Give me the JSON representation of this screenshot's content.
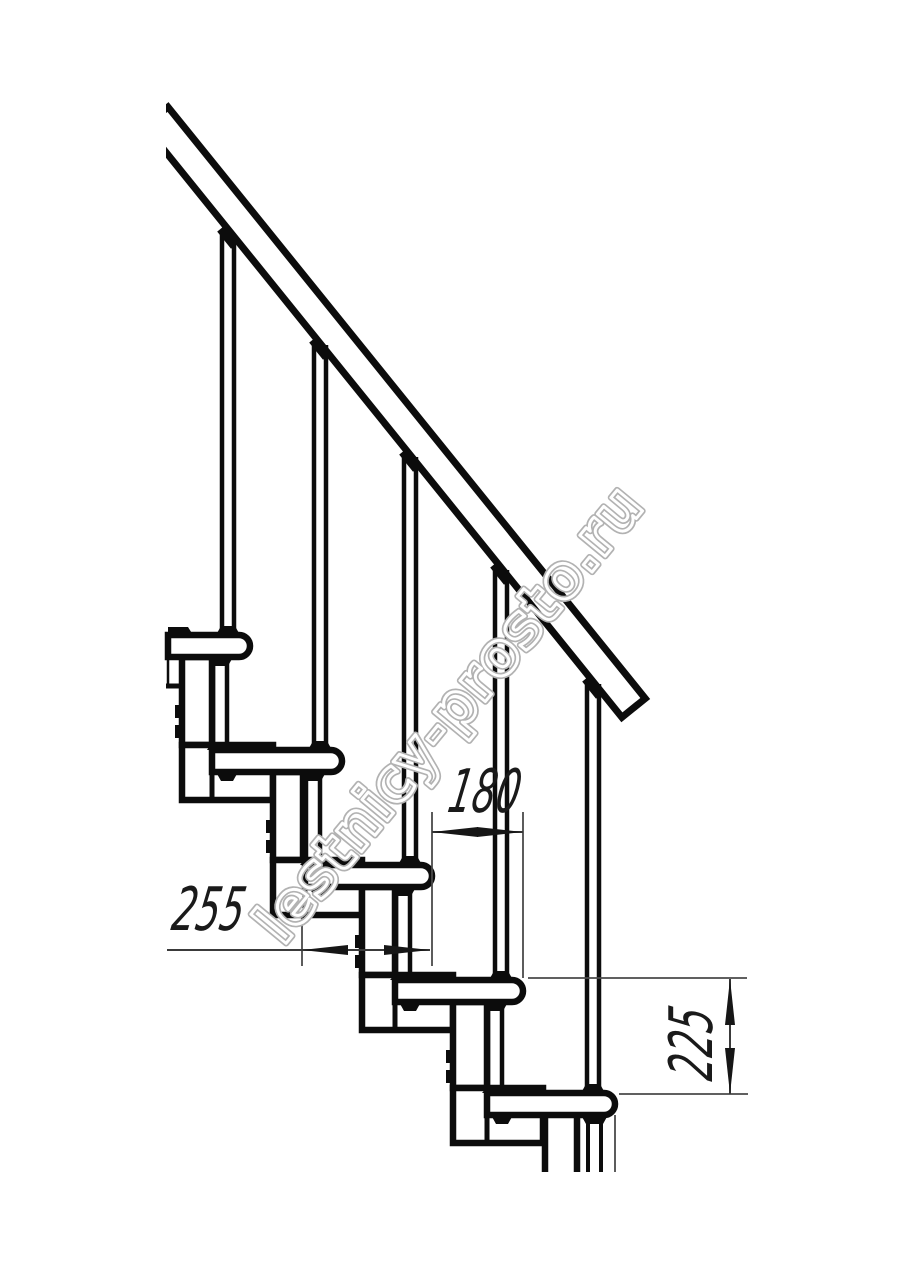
{
  "watermark": {
    "text": "lestnicy-prosto.ru",
    "color": "#b2b2b2"
  },
  "dims": {
    "spacing": "180",
    "run": "255",
    "rise": "225"
  },
  "colors": {
    "line": "#0c0c0c",
    "dimension": "#3a3a3a",
    "background": "#ffffff"
  }
}
